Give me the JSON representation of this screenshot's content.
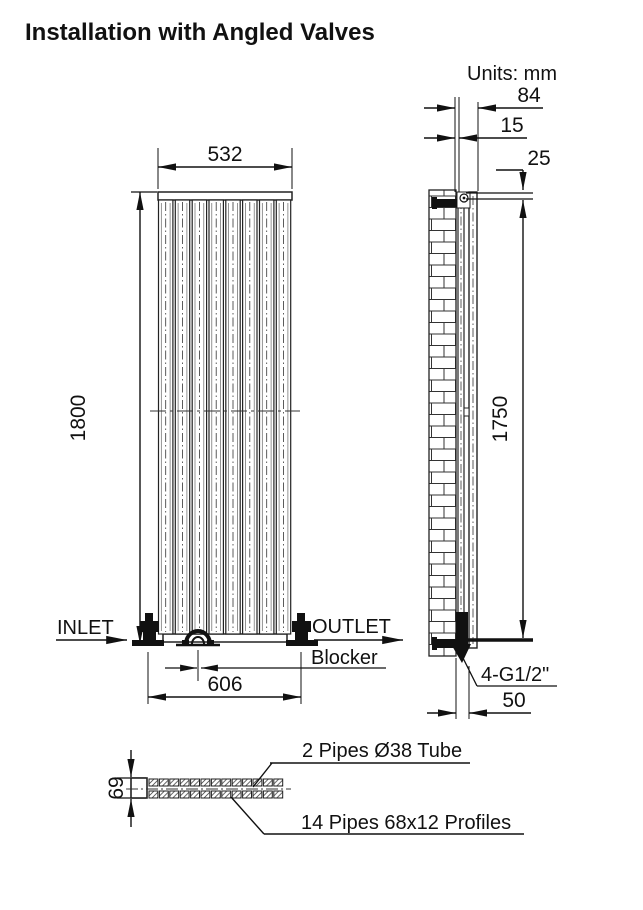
{
  "title": "Installation with Angled Valves",
  "units_label": "Units: mm",
  "colors": {
    "line": "#1a1a1a",
    "background": "#ffffff"
  },
  "front_view": {
    "dims": {
      "width": "532",
      "height": "1800",
      "valve_spacing": "606"
    },
    "labels": {
      "inlet": "INLET",
      "outlet": "OUTLET",
      "blocker": "Blocker"
    }
  },
  "side_view": {
    "dims": {
      "depth_with_bracket": "84",
      "wall_gap": "15",
      "top_to_bracket": "25",
      "bracket_span": "1750",
      "wall_to_connection": "50"
    },
    "labels": {
      "connections": "4-G1/2\""
    }
  },
  "bottom_view": {
    "dims": {
      "depth": "69"
    },
    "labels": {
      "tubes": "2 Pipes Ø38 Tube",
      "profiles": "14 Pipes 68x12 Profiles"
    }
  }
}
